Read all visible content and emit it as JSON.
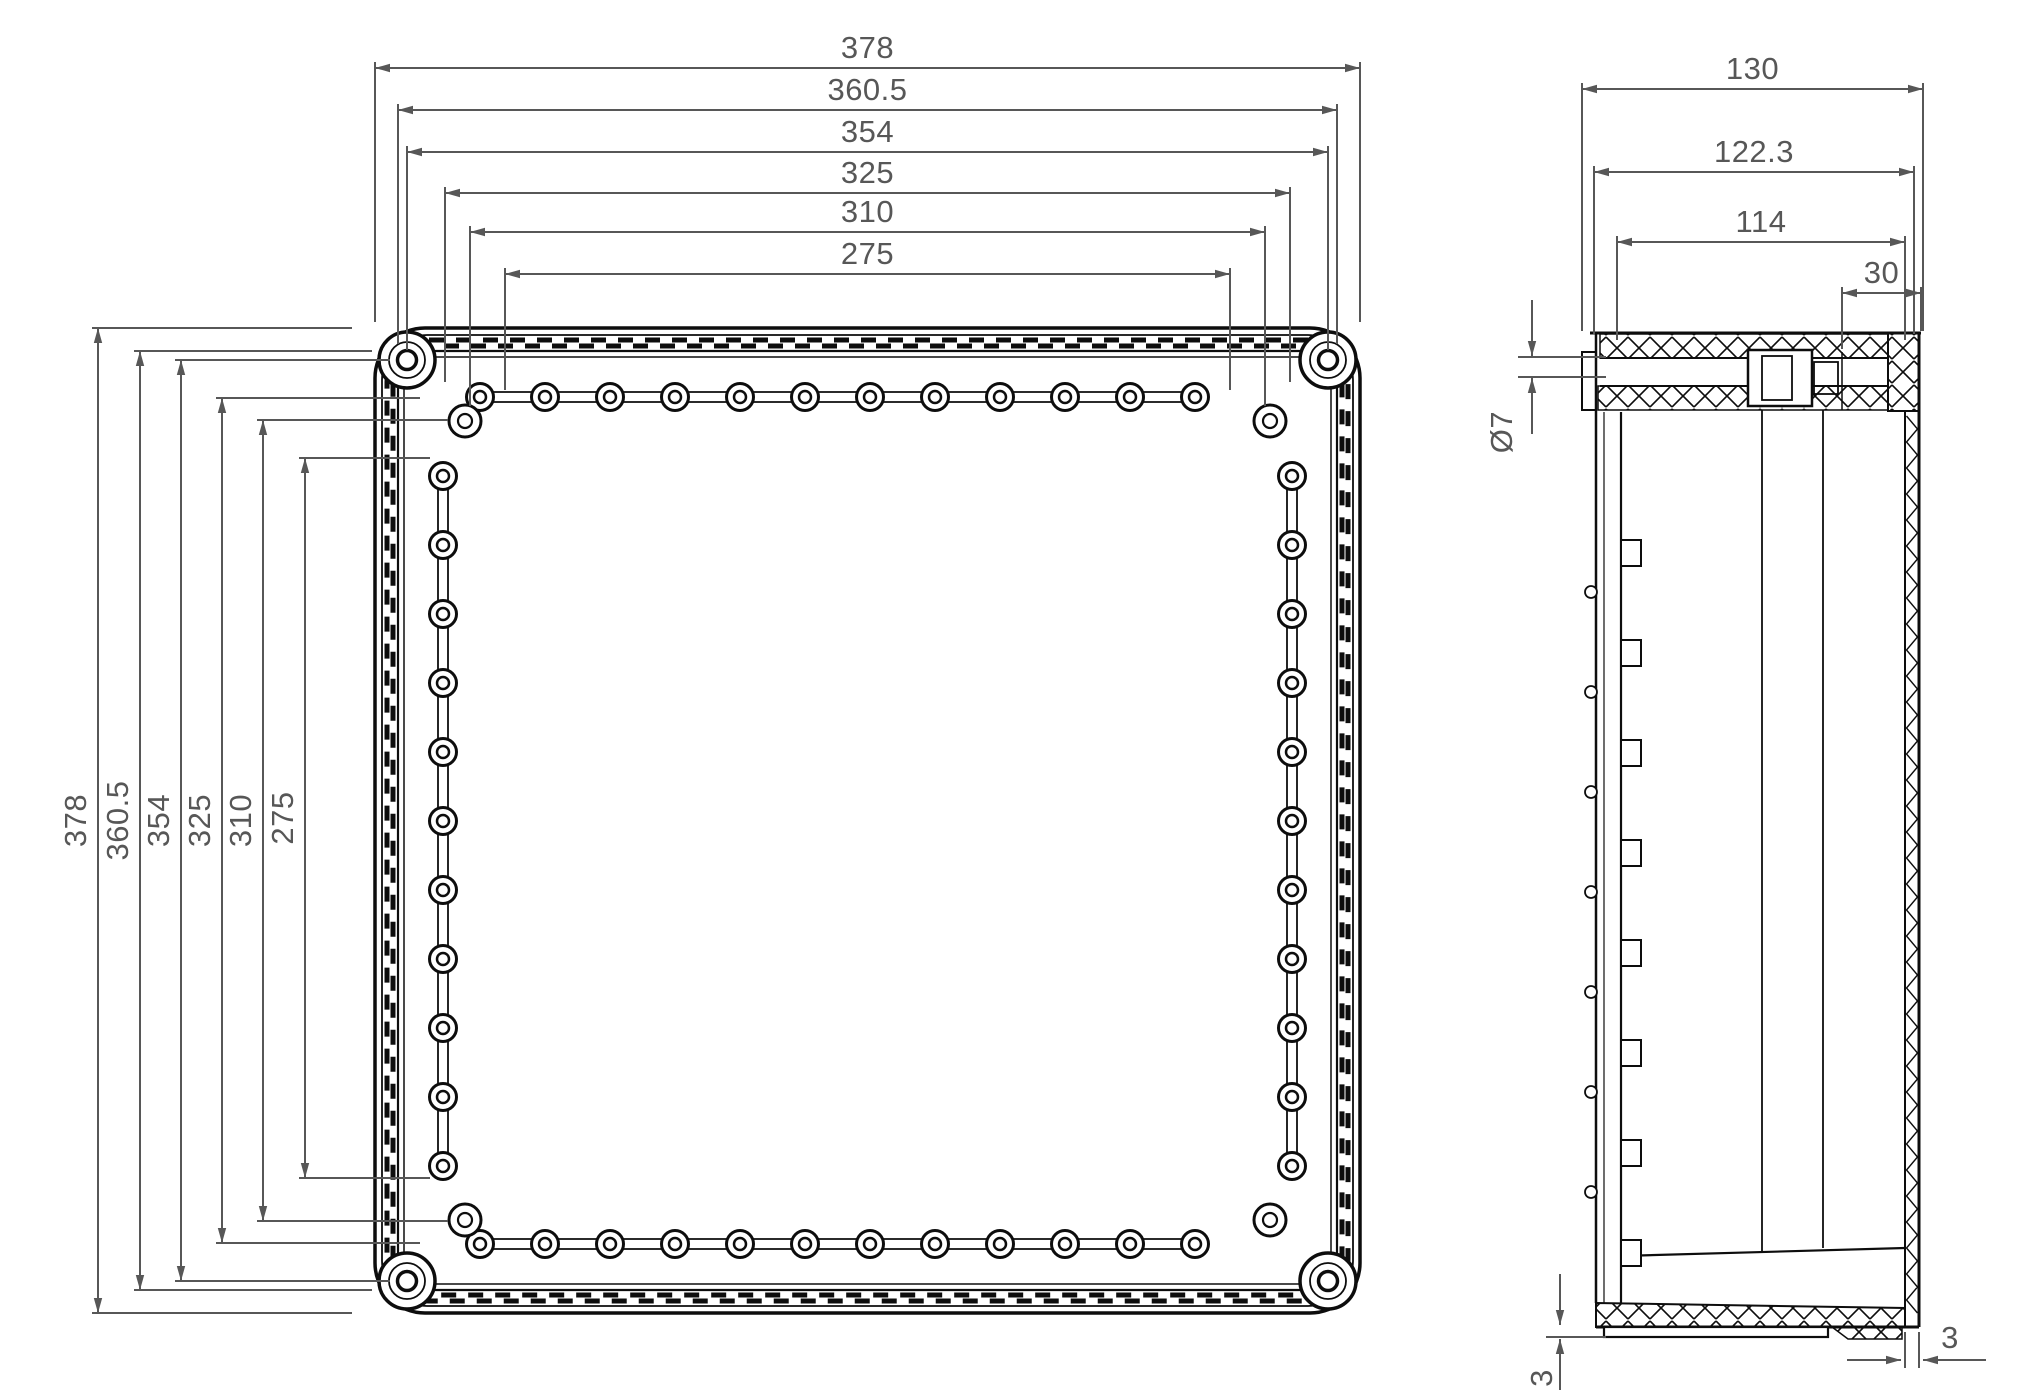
{
  "front_view": {
    "dims_top": [
      "378",
      "360.5",
      "354",
      "325",
      "310",
      "275"
    ],
    "dims_left": [
      "378",
      "360.5",
      "354",
      "325",
      "310",
      "275"
    ]
  },
  "side_view": {
    "dims_top": [
      "130",
      "122.3",
      "114",
      "30"
    ],
    "hole_diameter": "Ø7",
    "wall_bottom": "3",
    "wall_right": "3"
  },
  "colors": {
    "line": "#0d0d0d",
    "dimension": "#575757",
    "background": "#ffffff"
  }
}
